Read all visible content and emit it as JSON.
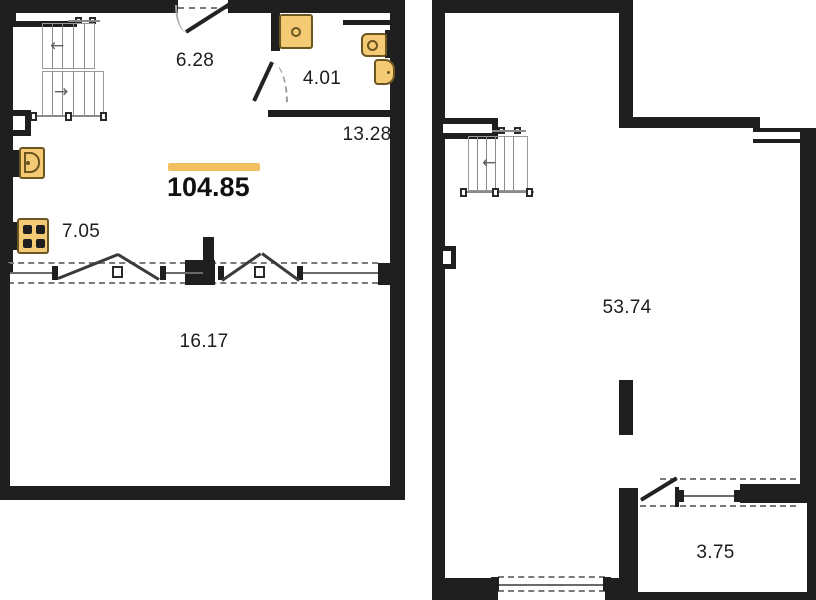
{
  "plan": {
    "type": "two-level apartment floor plan",
    "accent_color": "#f1bf60",
    "wall_color": "#1f1f1f",
    "fixture_fill_color": "#f5ca75",
    "fixture_border_color": "#6b5520",
    "total_area": "104.85",
    "floor1": {
      "rooms": [
        {
          "id": "hallway",
          "area": "6.28"
        },
        {
          "id": "bathroom",
          "area": "4.01"
        },
        {
          "id": "room-right",
          "area": "13.28"
        },
        {
          "id": "kitchen",
          "area": "7.05"
        },
        {
          "id": "terrace",
          "area": "16.17"
        }
      ],
      "fixtures": [
        "staircase",
        "shower",
        "washbasin",
        "toilet",
        "kitchen-sink",
        "stove",
        "entry-door",
        "bathroom-door",
        "french-windows"
      ]
    },
    "floor2": {
      "rooms": [
        {
          "id": "main-room",
          "area": "53.74"
        },
        {
          "id": "balcony",
          "area": "3.75"
        }
      ],
      "fixtures": [
        "staircase",
        "balcony-door",
        "windows"
      ]
    },
    "glyphs": {
      "stair_arrow_left": "←",
      "stair_arrow_right": "→"
    }
  }
}
